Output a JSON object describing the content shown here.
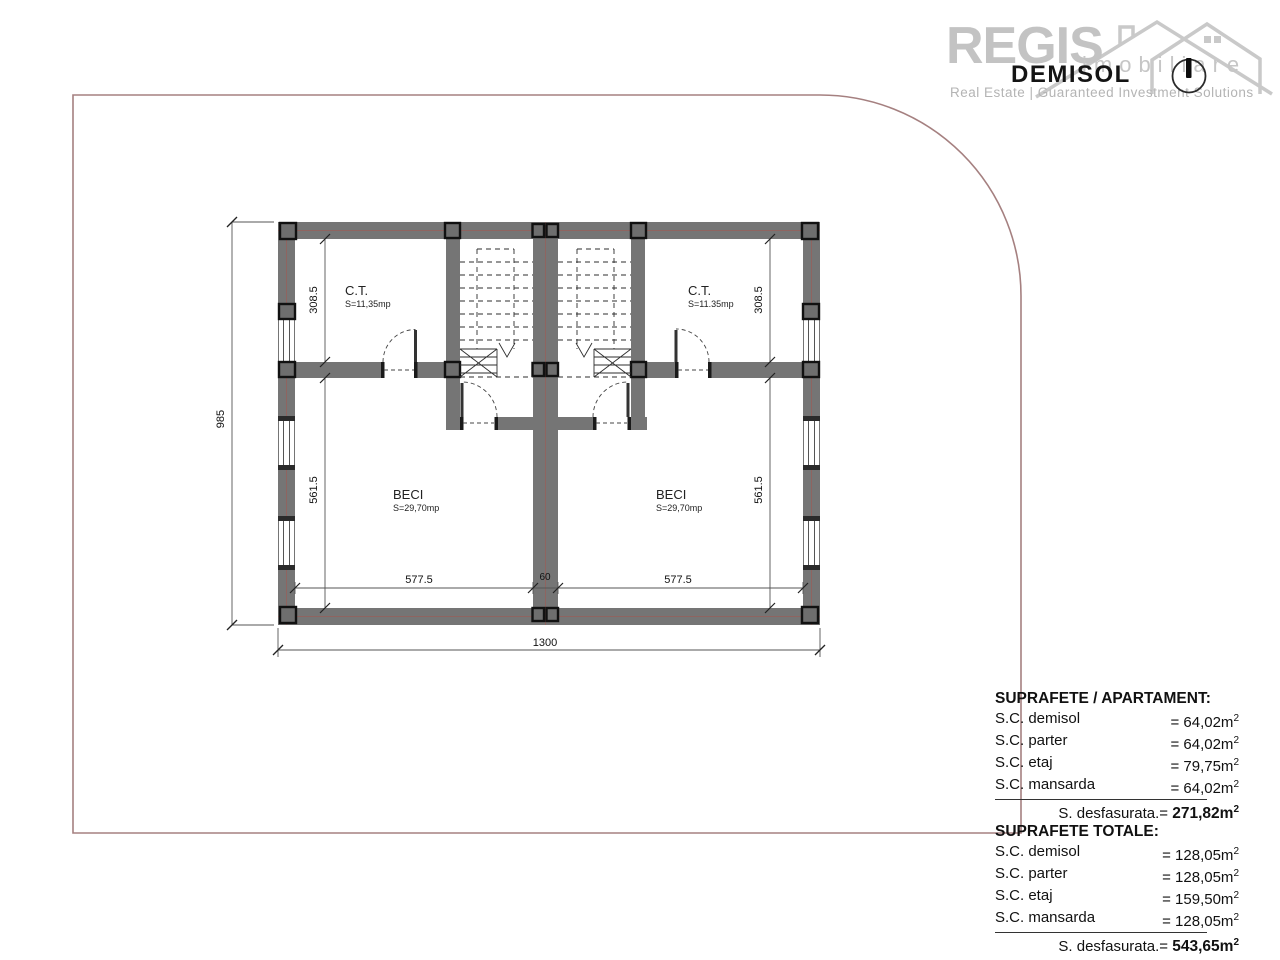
{
  "logo": {
    "brand": "REGIS",
    "word": "imobiliare",
    "tagline": "Real Estate | Guaranteed Investment Solutions"
  },
  "title": "DEMISOL",
  "plan": {
    "rooms": {
      "ct_left": {
        "name": "C.T.",
        "area": "S=11,35mp"
      },
      "ct_right": {
        "name": "C.T.",
        "area": "S=11.35mp"
      },
      "beci_left": {
        "name": "BECI",
        "area": "S=29,70mp"
      },
      "beci_right": {
        "name": "BECI",
        "area": "S=29,70mp"
      }
    },
    "dims": {
      "total_height": "985",
      "total_width": "1300",
      "left_upper": "308.5",
      "left_lower": "561.5",
      "right_upper": "308.5",
      "right_lower": "561.5",
      "bottom_left": "577.5",
      "bottom_center": "60",
      "bottom_right": "577.5"
    }
  },
  "units": {
    "sup": "2"
  },
  "tables": [
    {
      "title": "SUPRAFETE / APARTAMENT:",
      "rows": [
        {
          "label": "S.C. demisol",
          "value": "= 64,02m"
        },
        {
          "label": "S.C. parter",
          "value": "= 64,02m"
        },
        {
          "label": "S.C. etaj",
          "value": "= 79,75m"
        },
        {
          "label": "S.C. mansarda",
          "value": "= 64,02m"
        }
      ],
      "total_label": "S. desfasurata.=",
      "total_value": "271,82m"
    },
    {
      "title": "SUPRAFETE TOTALE:",
      "rows": [
        {
          "label": "S.C. demisol",
          "value": "= 128,05m"
        },
        {
          "label": "S.C. parter",
          "value": "= 128,05m"
        },
        {
          "label": "S.C. etaj",
          "value": "= 159,50m"
        },
        {
          "label": "S.C. mansarda",
          "value": "= 128,05m"
        }
      ],
      "total_label": "S. desfasurata.=",
      "total_value": "543,65m"
    }
  ]
}
